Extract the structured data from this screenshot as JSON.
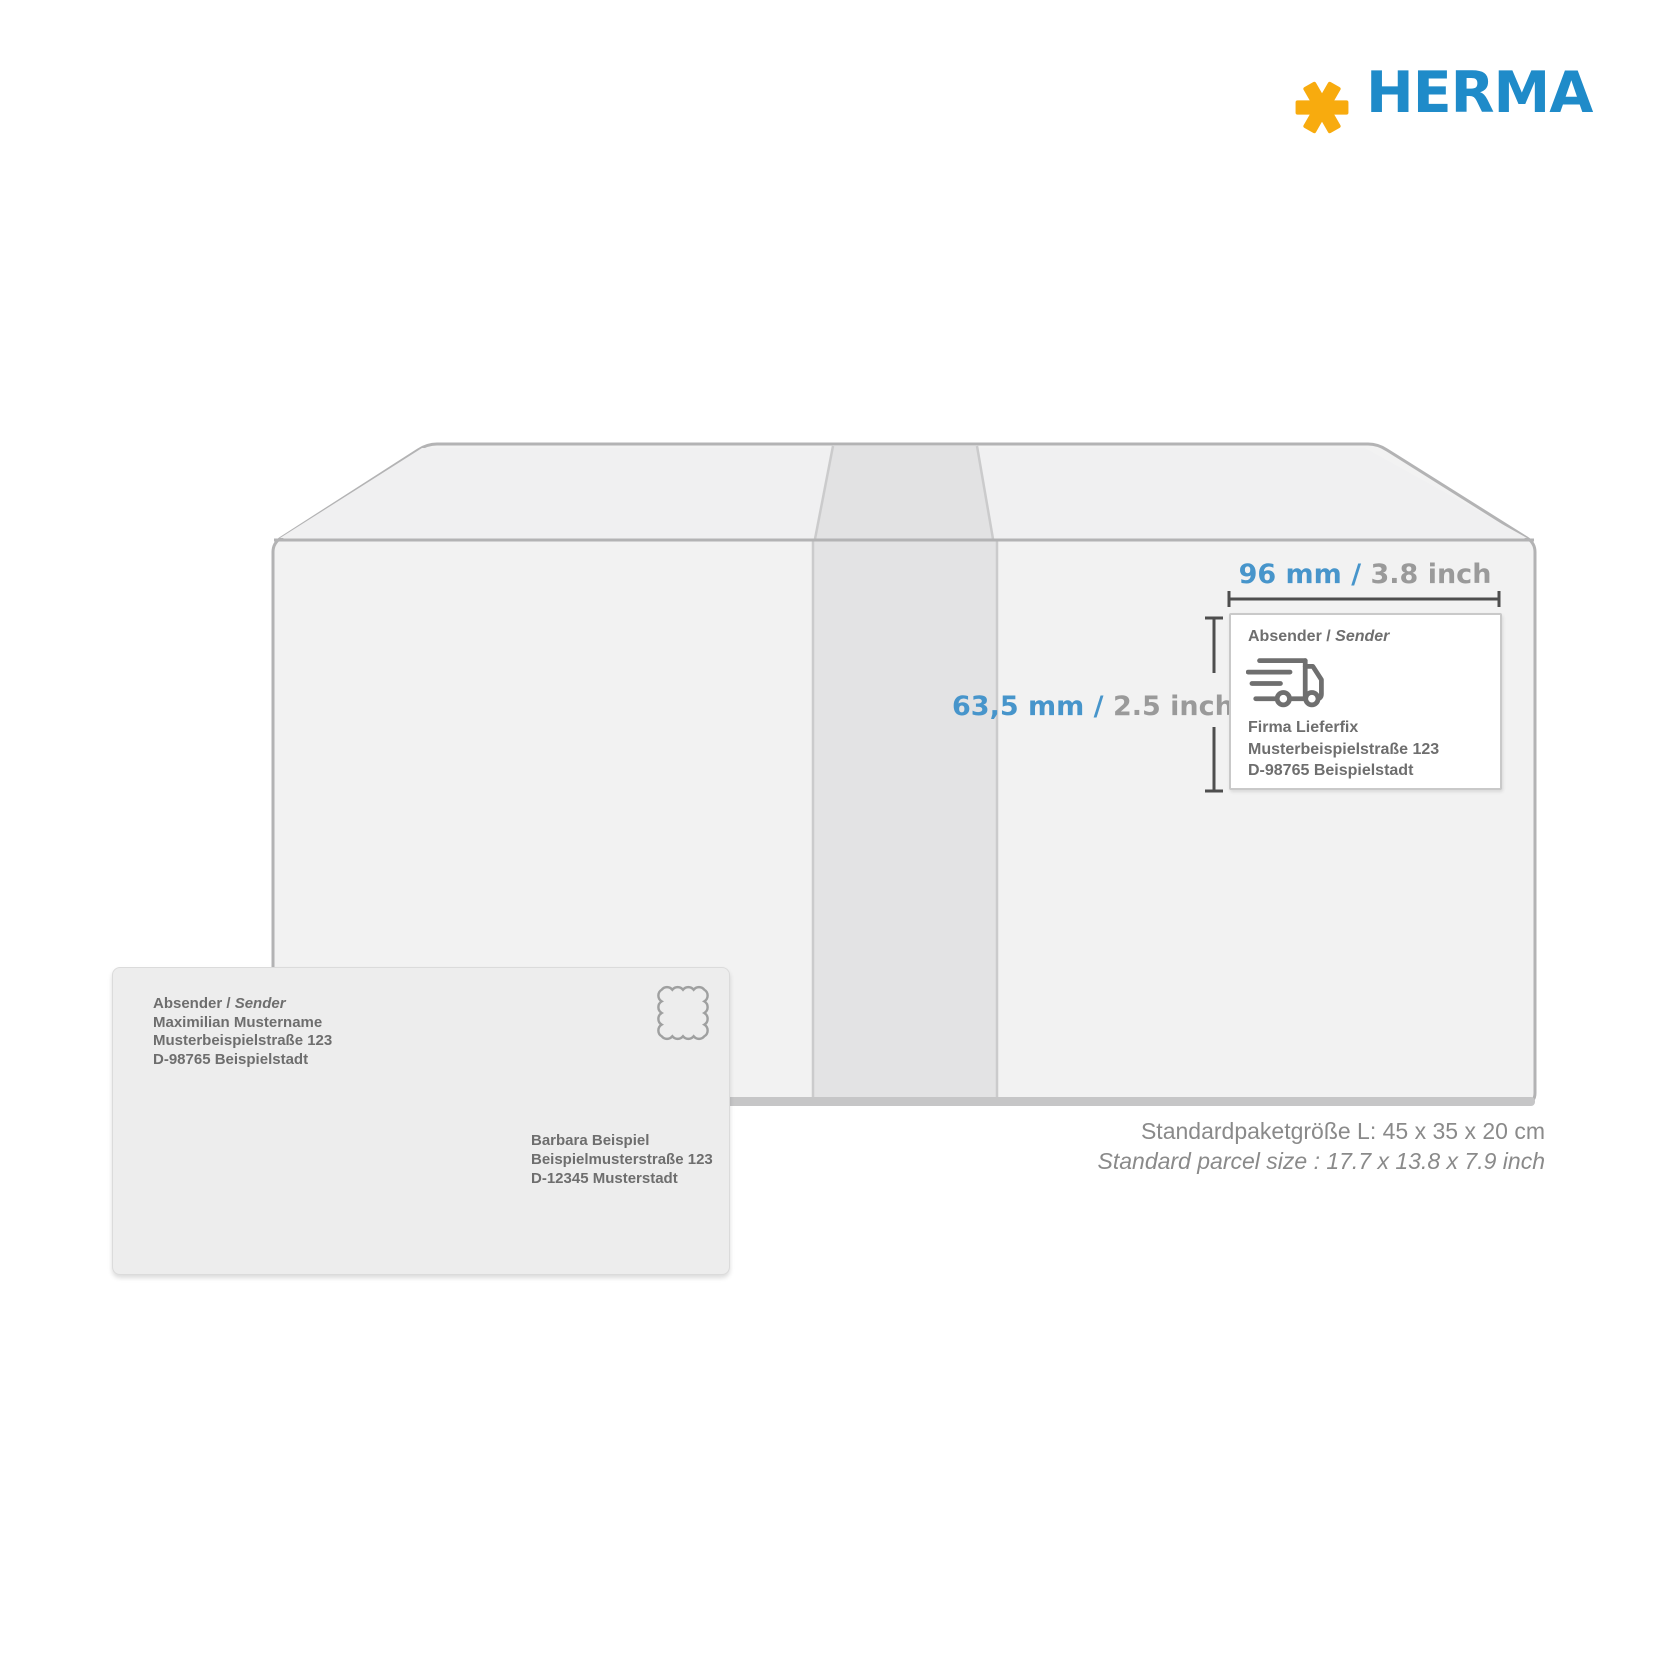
{
  "brand": {
    "name": "HERMA",
    "wordmark_color": "#1F8BC9",
    "asterisk_color": "#F8AB0E"
  },
  "package_dimensions": {
    "width_label": {
      "metric": "96 mm /",
      "imperial": " 3.8 inch"
    },
    "height_label": {
      "metric": "63,5 mm /",
      "imperial": " 2.5 inch"
    },
    "accent_color": "#4795CB",
    "muted_color": "#9A9A9A",
    "line_color": "#4E4E4E"
  },
  "shipping_label": {
    "header_prefix": "Absender / ",
    "header_italic": "Sender",
    "icon": "delivery-truck-icon",
    "address": [
      "Firma Lieferfix",
      "Musterbeispielstraße 123",
      "D-98765 Beispielstadt"
    ]
  },
  "envelope": {
    "sender_header_prefix": "Absender / ",
    "sender_header_italic": "Sender",
    "sender_address": [
      "Maximilian Mustername",
      "Musterbeispielstraße 123",
      "D-98765 Beispielstadt"
    ],
    "recipient_address": [
      "Barbara Beispiel",
      "Beispielmusterstraße 123",
      "D-12345 Musterstadt"
    ],
    "stamp_icon": "postage-stamp-icon"
  },
  "caption": {
    "line_de": "Standardpaketgröße L: 45 x 35 x 20 cm",
    "line_en": "Standard parcel size : 17.7 x 13.8 x 7.9 inch"
  }
}
